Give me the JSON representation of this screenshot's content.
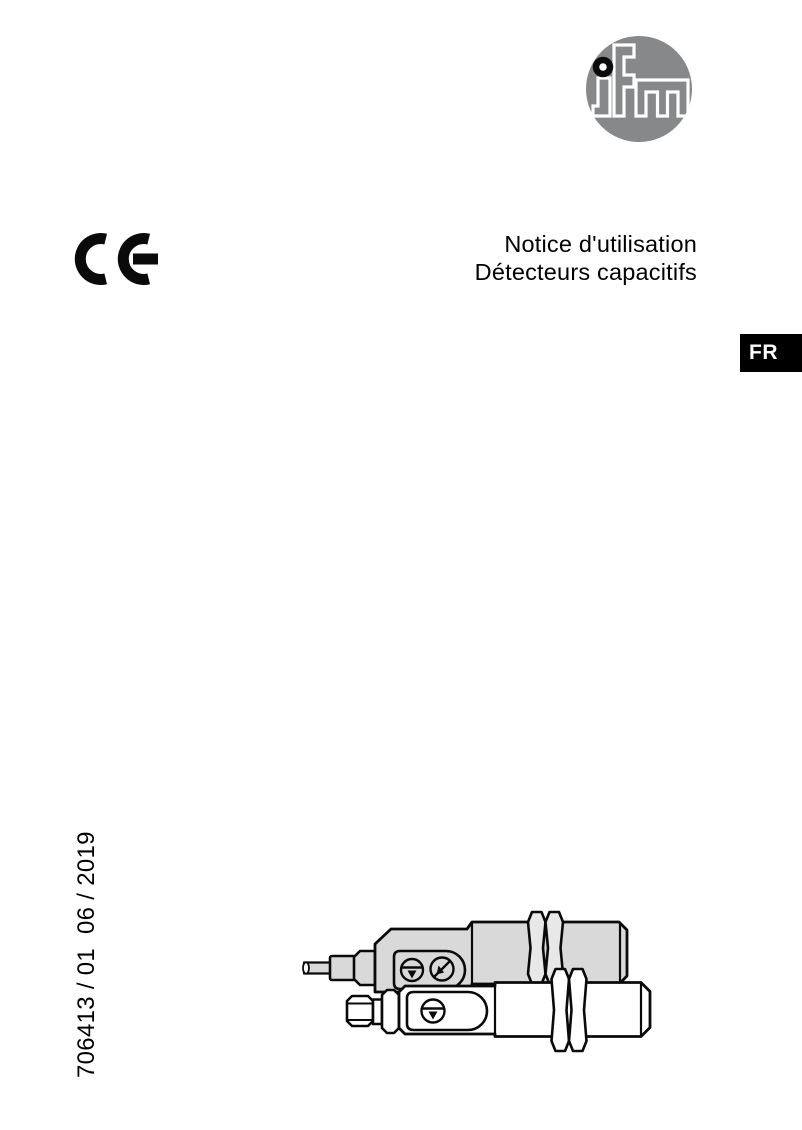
{
  "page": {
    "type": "operating-instructions-cover"
  },
  "logo": {
    "text": "ifm"
  },
  "ce_mark": "CE",
  "title": {
    "line1": "Notice d'utilisation",
    "line2": "Détecteurs capacitifs"
  },
  "language_badge": {
    "label": "FR"
  },
  "document_number": "706413 / 01  06 / 2019",
  "illustration": {
    "description": "two capacitive proximity sensors (cable version and connector version) with mounting nuts and potentiometer screws"
  },
  "colors": {
    "logo_gray": "#87888a",
    "drawing_gray": "#d9d9d9",
    "nut_gray": "#e8e8e8",
    "badge_bg": "#000000",
    "badge_fg": "#ffffff",
    "line_color": "#0a0a0a",
    "page_bg": "#ffffff"
  }
}
